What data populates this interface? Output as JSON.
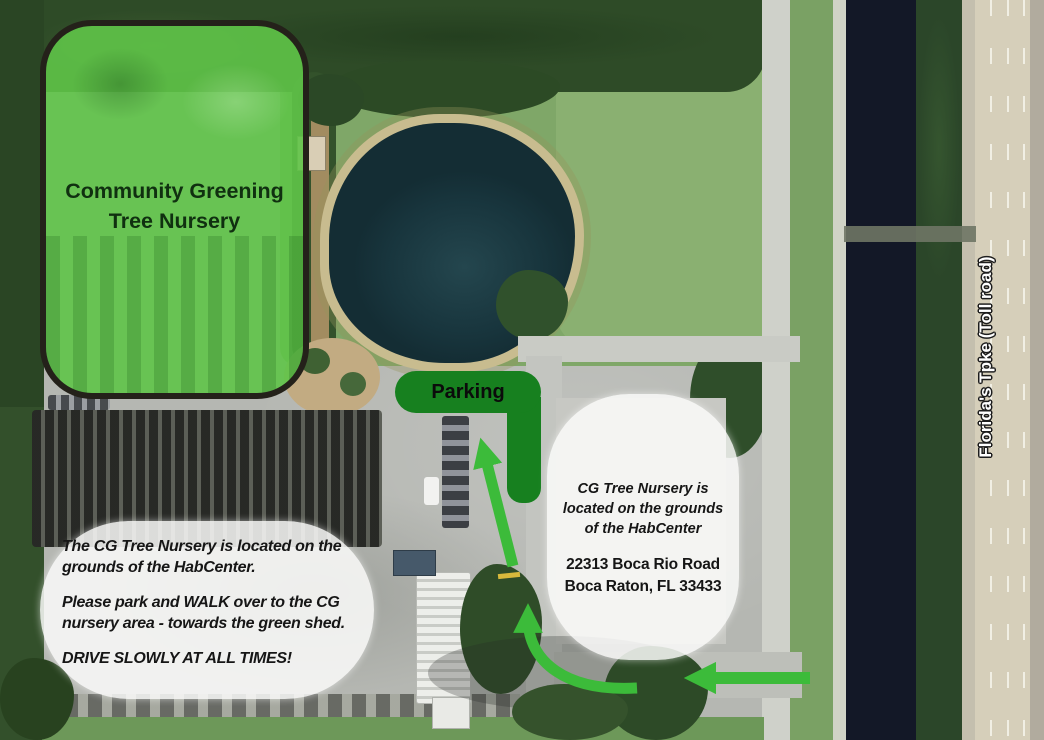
{
  "map": {
    "nursery_overlay": {
      "line1": "Community Greening",
      "line2": "Tree Nursery"
    },
    "parking": {
      "label": "Parking"
    },
    "bubble_right": {
      "note1": "CG Tree Nursery is",
      "note2": "located on the grounds",
      "note3": "of the HabCenter",
      "address1": "22313 Boca Rio Road",
      "address2": "Boca Raton, FL 33433"
    },
    "bubble_left": {
      "p1l1": "The CG Tree Nursery is located on the",
      "p1l2": "grounds of the HabCenter.",
      "p2l1": "Please park and WALK over to the CG",
      "p2l2": "nursery area - towards the green shed.",
      "p3": "DRIVE SLOWLY AT ALL TIMES!"
    },
    "highway_label": "Florida's Tpke (Toll road)",
    "colors": {
      "arrow": "#3cbb3a",
      "parking_green": "#17801f",
      "overlay_green": "#5fc448",
      "canal_water": "#131827",
      "pond_water": "#1b3a42"
    }
  }
}
